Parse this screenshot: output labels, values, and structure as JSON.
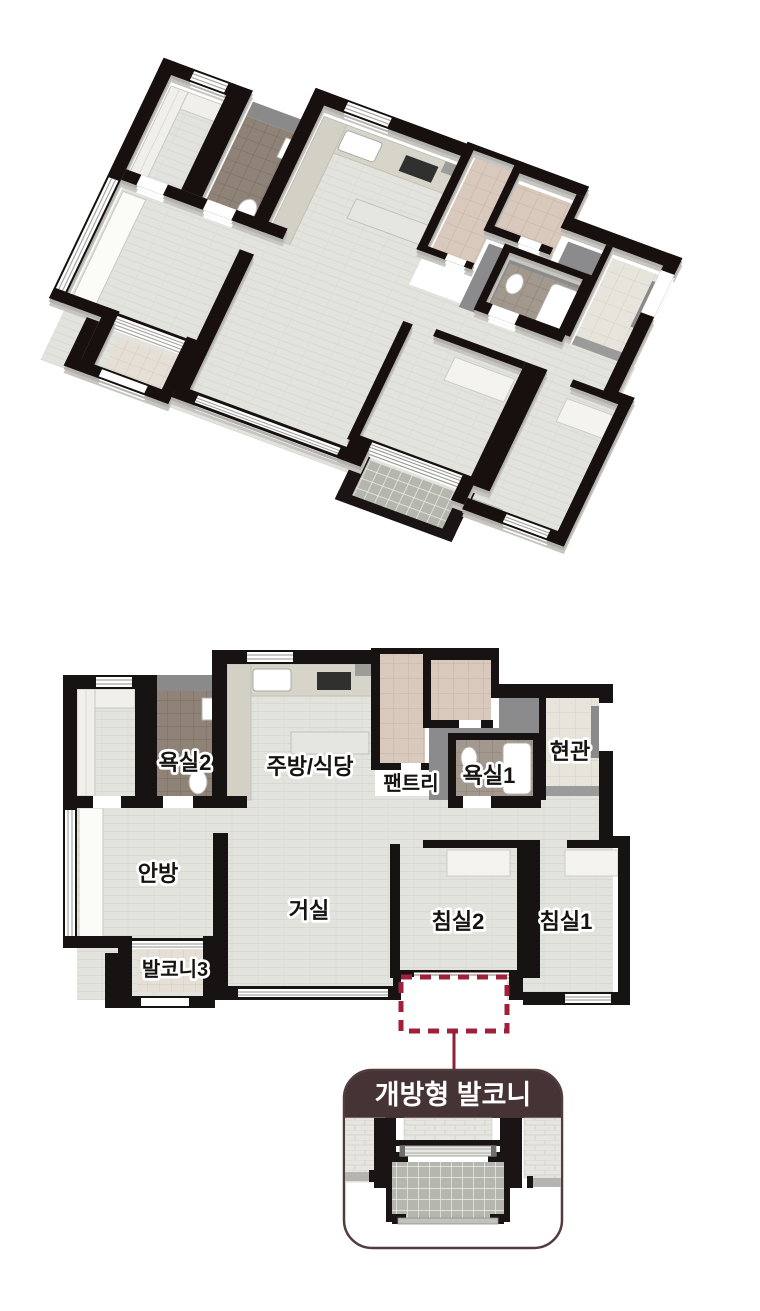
{
  "figure": {
    "kind": "apartment-unit-floor-plan",
    "views": {
      "isometric_label": "3d-cutaway-view",
      "plan_label": "2d-floor-plan",
      "detail_label": "open-balcony-detail"
    }
  },
  "plan": {
    "rooms": {
      "bathroom2": "욕실2",
      "kitchen_dining": "주방/식당",
      "pantry": "팬트리",
      "bathroom1": "욕실1",
      "entrance": "현관",
      "master_bedroom": "안방",
      "living_room": "거실",
      "bedroom2": "침실2",
      "bedroom1": "침실1",
      "balcony3": "발코니3"
    },
    "callout": {
      "label": "개방형 발코니"
    },
    "colors": {
      "wall": "#171312",
      "floor_wood": "#e2e3dd",
      "corridor_gray": "#8b8b8d",
      "bath_tile": "#9a8e84",
      "pantry_tile": "#d9c9bd",
      "dashed_accent": "#a11f3a",
      "connector_line": "#8e2135",
      "callout_header": "#463335",
      "callout_border": "#533c3e"
    }
  }
}
